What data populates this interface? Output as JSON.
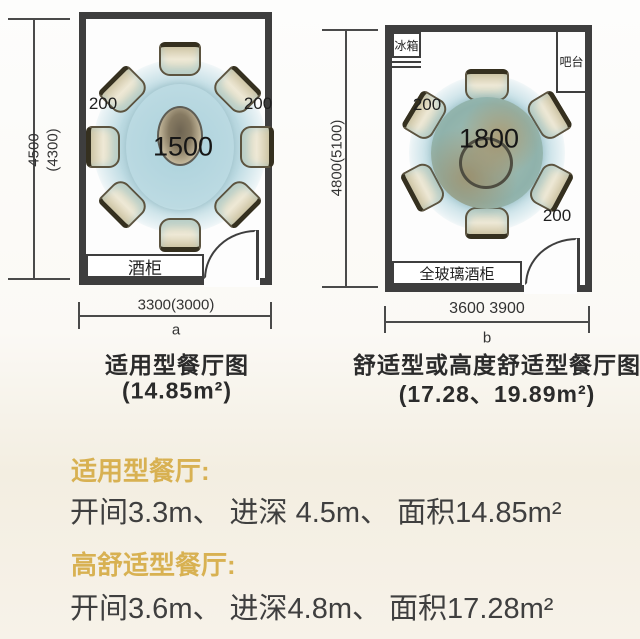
{
  "plans": {
    "left": {
      "dim_height_l1": "4500",
      "dim_height_l2": "(4300)",
      "dim_width": "3300(3000)",
      "axis_marker": "a",
      "table_size": "1500",
      "gap_left": "200",
      "gap_right": "200",
      "cabinet": "酒柜",
      "caption_title": "适用型餐厅图",
      "caption_area": "(14.85m²)"
    },
    "right": {
      "dim_height": "4800(5100)",
      "dim_width": "3600 3900",
      "axis_marker": "b",
      "table_size": "1800",
      "gap_top": "200",
      "gap_bottom": "200",
      "fridge": "冰箱",
      "bar": "吧台",
      "cabinet": "全玻璃酒柜",
      "caption_title": "舒适型或高度舒适型餐厅图",
      "caption_area": "(17.28、19.89m²)"
    }
  },
  "notes": {
    "heading1": "适用型餐厅:",
    "body1": "开间3.3m、 进深 4.5m、 面积14.85m²",
    "heading2": "高舒适型餐厅:",
    "body2": "开间3.6m、 进深4.8m、 面积17.28m²"
  },
  "colors": {
    "accent_gold": "#d8b152",
    "wall": "#3e3e3e",
    "text_dark": "#3f3f3f",
    "table_blue": "#c2d7db",
    "table_teal": "#8fb2ab",
    "chair_cream": "#e9e3cb"
  }
}
